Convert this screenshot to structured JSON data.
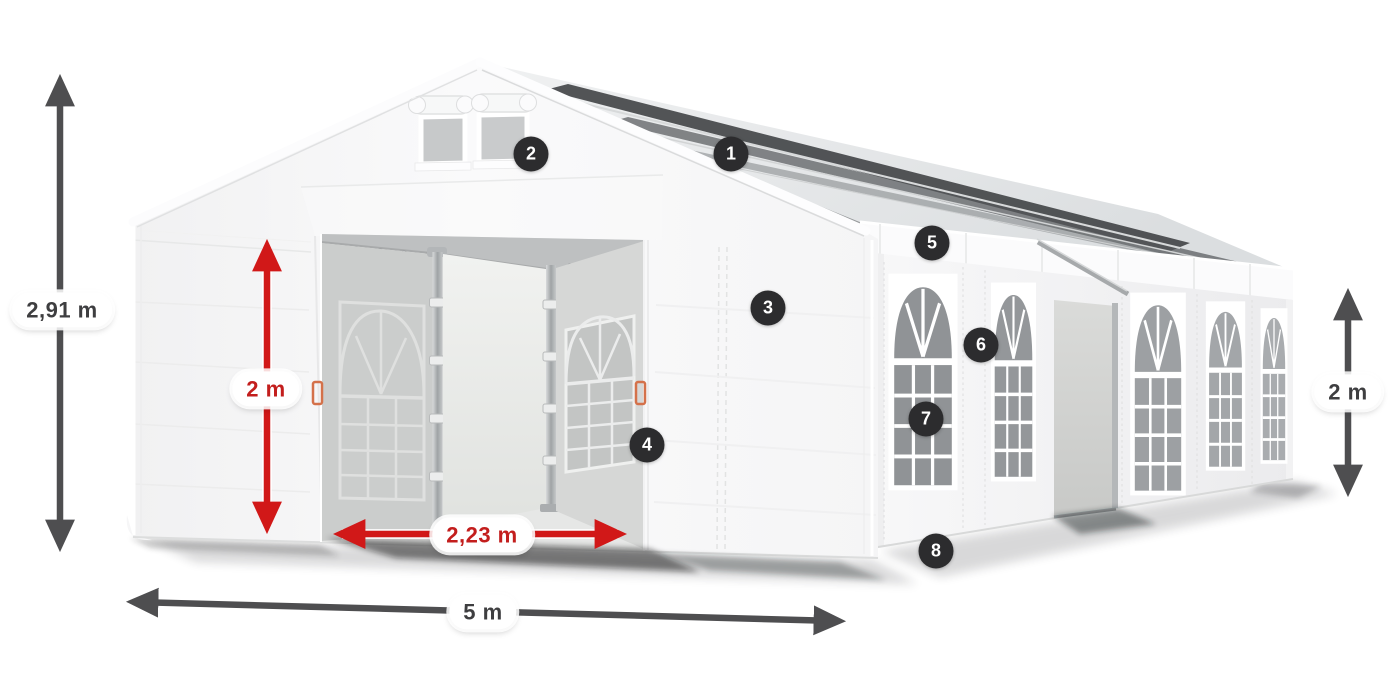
{
  "diagram": {
    "type": "tent-dimensions-product-diagram",
    "subject": "white marquee party tent with windows, open front entrance and numbered feature hotspots",
    "dimensions": {
      "total_height": "2,91 m",
      "entrance_height": "2 m",
      "entrance_width": "2,23 m",
      "front_width": "5 m",
      "side_wall_height": "2 m"
    },
    "markers": [
      {
        "label": "1"
      },
      {
        "label": "2"
      },
      {
        "label": "3"
      },
      {
        "label": "4"
      },
      {
        "label": "5"
      },
      {
        "label": "6"
      },
      {
        "label": "7"
      },
      {
        "label": "8"
      }
    ],
    "colors": {
      "dimension_red": "#c9201d",
      "dimension_gray": "#4e4e50",
      "marker_background": "#2c2c2e",
      "marker_text": "#ffffff",
      "tent_fabric": "#f7f7f8",
      "window_glass": "#97999c"
    }
  }
}
